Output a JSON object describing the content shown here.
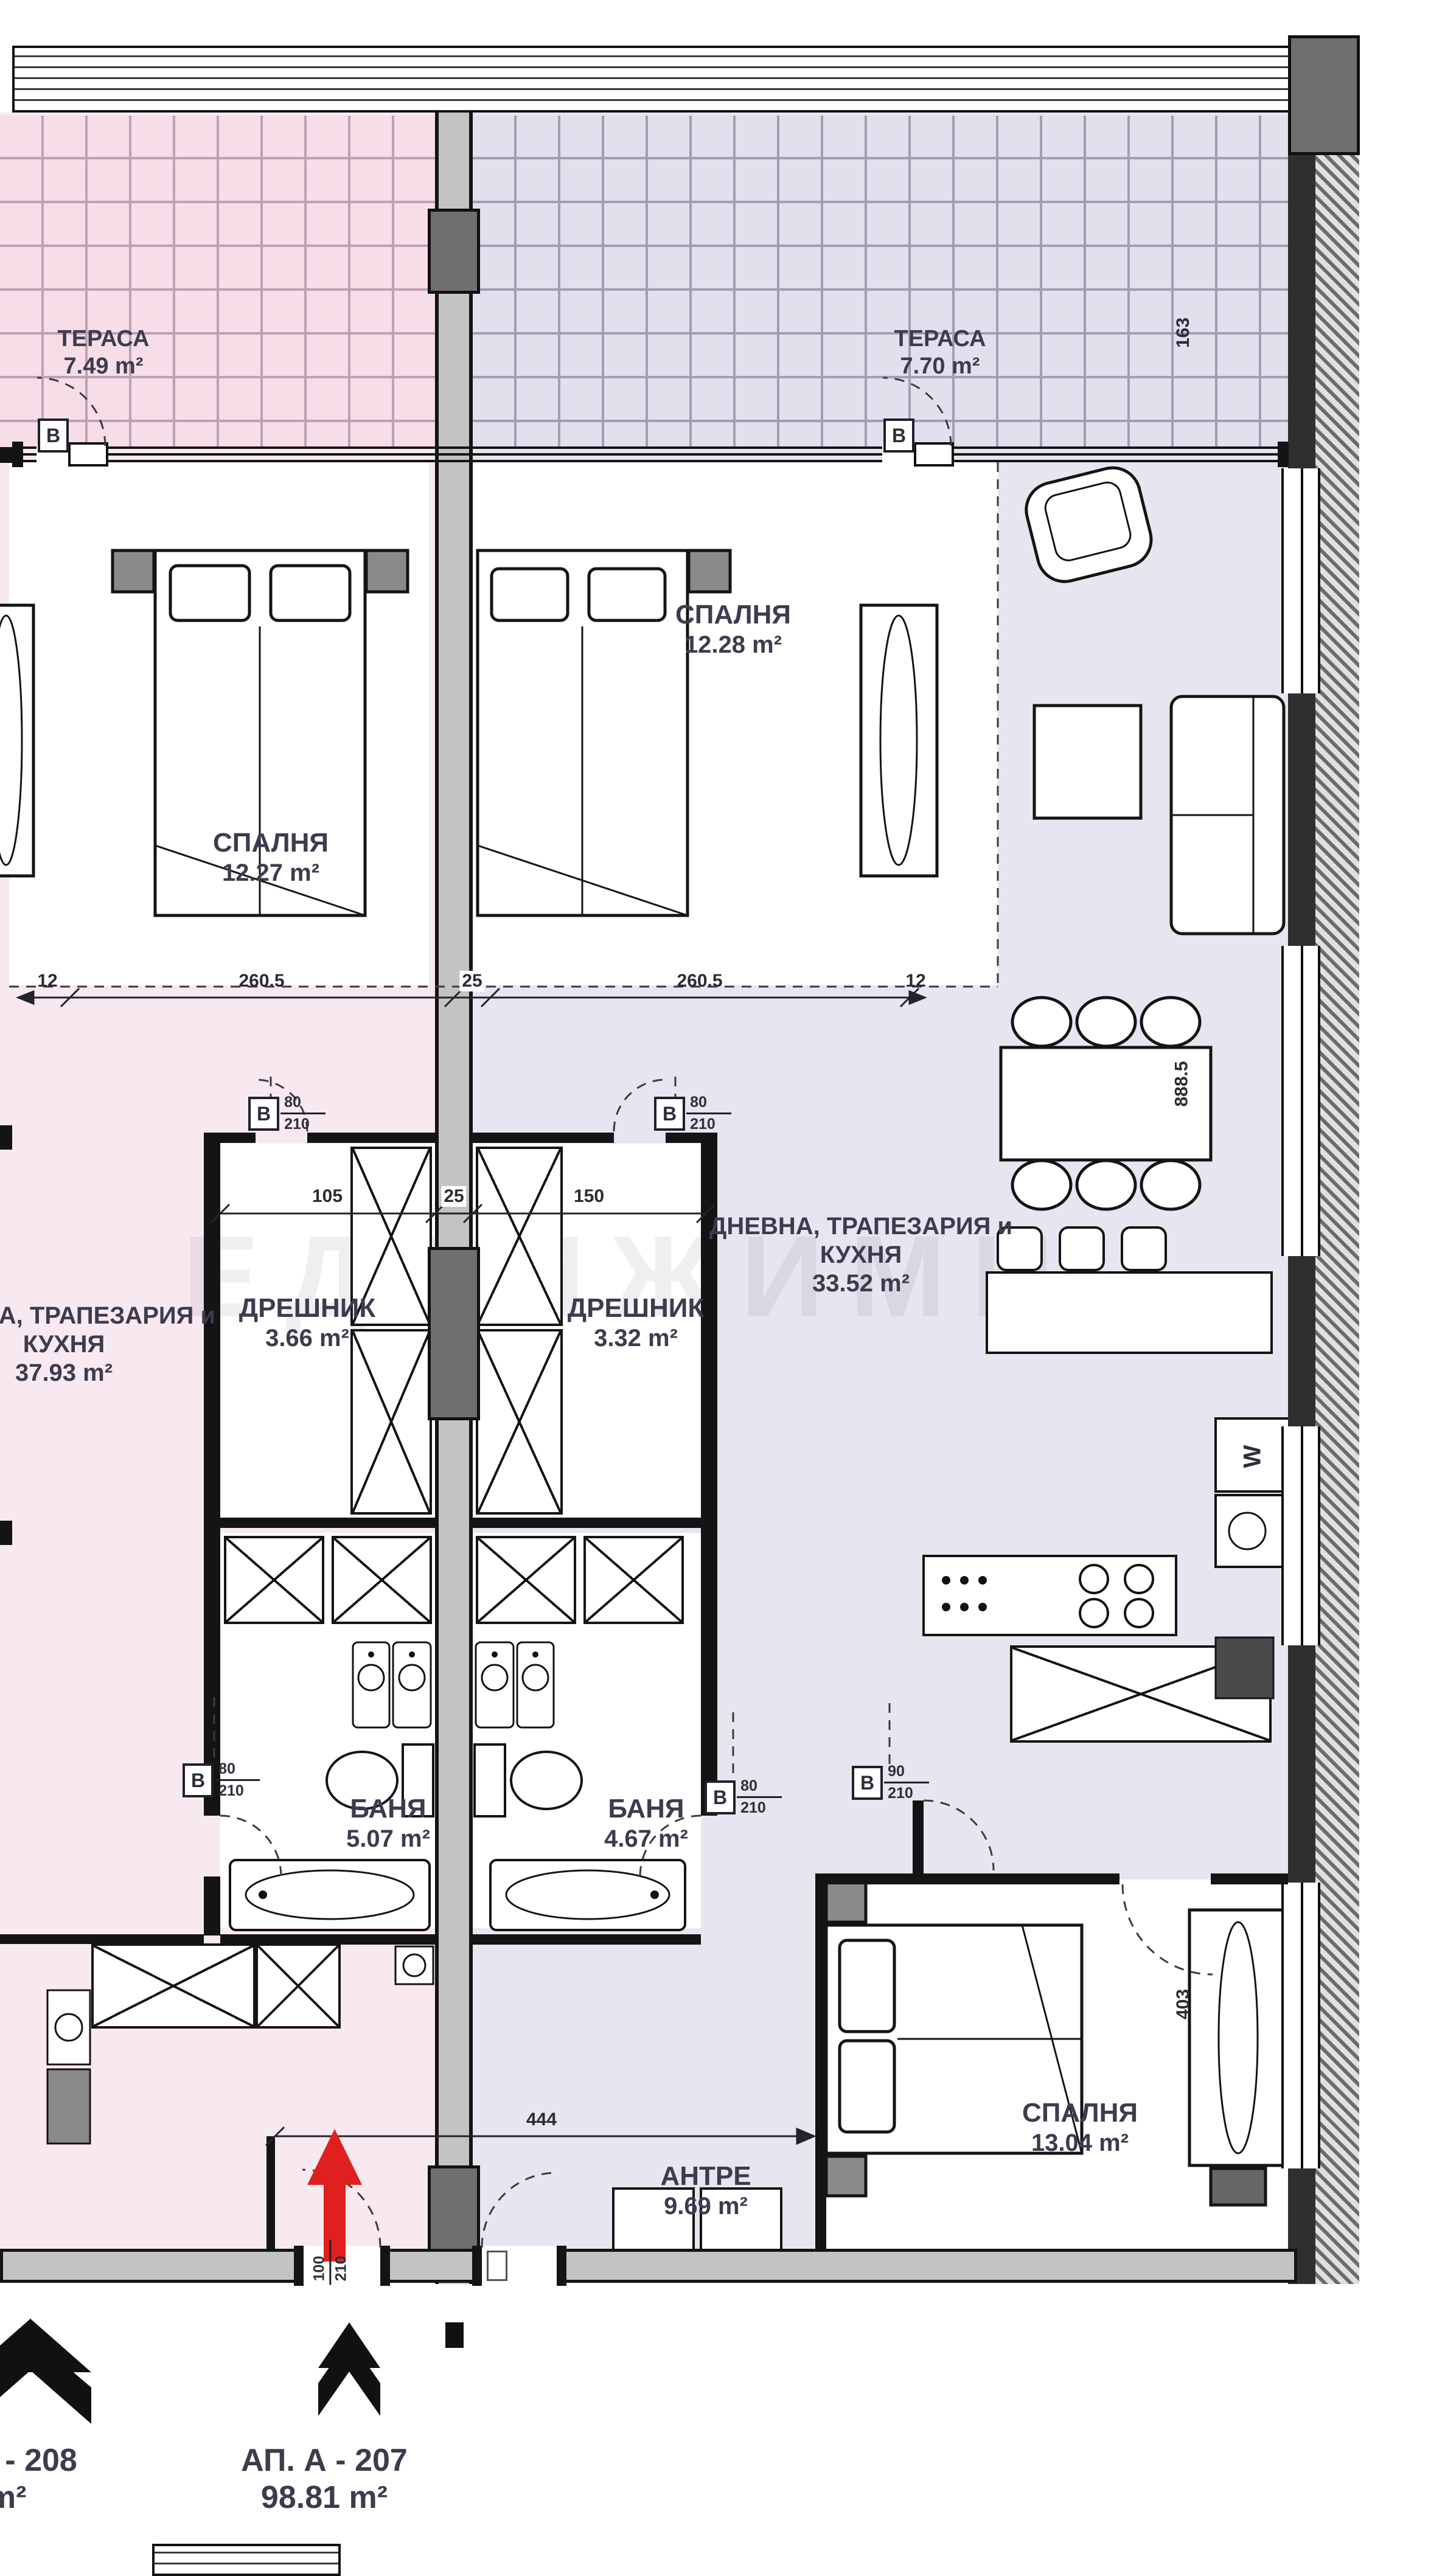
{
  "rooms": {
    "terrace_left": {
      "name": "ТЕРАСА",
      "area": "7.49 m²"
    },
    "terrace_right": {
      "name": "ТЕРАСА",
      "area": "7.70 m²"
    },
    "bedroom_left": {
      "name": "СПАЛНЯ",
      "area": "12.27 m²"
    },
    "bedroom_right": {
      "name": "СПАЛНЯ",
      "area": "12.28 m²"
    },
    "closet_left": {
      "name": "ДРЕШНИК",
      "area": "3.66 m²"
    },
    "closet_right": {
      "name": "ДРЕШНИК",
      "area": "3.32 m²"
    },
    "living_left": {
      "line1": "ДНЕВНА, ТРАПЕЗАРИЯ и",
      "line2": "КУХНЯ",
      "area": "37.93 m²"
    },
    "living_right": {
      "line1": "ДНЕВНА, ТРАПЕЗАРИЯ и",
      "line2": "КУХНЯ",
      "area": "33.52 m²"
    },
    "bath_left": {
      "name": "БАНЯ",
      "area": "5.07 m²"
    },
    "bath_right": {
      "name": "БАНЯ",
      "area": "4.67 m²"
    },
    "hall": {
      "name": "АНТРЕ",
      "area": "9.69 m²"
    },
    "bedroom_bottom": {
      "name": "СПАЛНЯ",
      "area": "13.04 m²"
    }
  },
  "apartments": {
    "a207": {
      "line1": "АП. А - 207",
      "line2": "98.81 m²"
    },
    "a208": {
      "line1": "АП. А - 208",
      "line2": "0 m²"
    }
  },
  "dimensions": {
    "d12_left": "12",
    "d2605_left": "260.5",
    "d25_center": "25",
    "d2605_right": "260.5",
    "d12_right": "12",
    "d105": "105",
    "d25_closet": "25",
    "d150": "150",
    "d444": "444",
    "d163": "163",
    "d8885": "888.5",
    "d403": "403"
  },
  "door_labels": {
    "terrace_left": {
      "letter": "В"
    },
    "terrace_right": {
      "letter": "В"
    },
    "closet_left": {
      "letter": "В",
      "num": "80",
      "den": "210"
    },
    "closet_right": {
      "letter": "В",
      "num": "80",
      "den": "210"
    },
    "bath_left": {
      "letter": "В",
      "num": "80",
      "den": "210"
    },
    "bath_right": {
      "letter": "В",
      "num": "80",
      "den": "210"
    },
    "hall": {
      "letter": "В",
      "num": "90",
      "den": "210"
    },
    "entry": {
      "num": "100",
      "den": "210"
    }
  },
  "kitchen": {
    "appliance_glyph": "W"
  },
  "watermark": "ЕДВИЖИМИ",
  "colors": {
    "left_floor": "#f8e9f0",
    "right_floor": "#e7e5ef",
    "wall_gray": "#c3c3c3",
    "red_arrow": "#e01f1f"
  }
}
